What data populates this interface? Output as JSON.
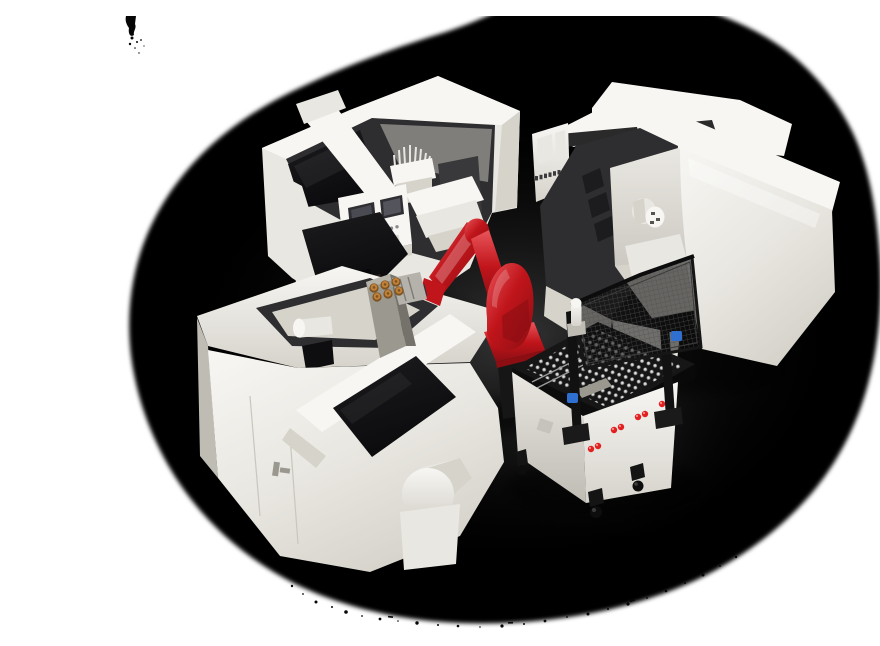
{
  "scene": {
    "title": "Robotic CNC machine tending cell",
    "alt": "3D render: three white CNC lathes around a red six-axis industrial robot holding brass parts, with a parts staging cart, pin pallet, safety mesh fence and signal column on a black floor"
  },
  "palette": {
    "background": "#ffffff",
    "blob_black": "#050505",
    "floor_center": "#3a3a3c",
    "machine_hi": "#f7f6f3",
    "machine_mid": "#e9e7e1",
    "machine_shade": "#d6d3cb",
    "machine_deep": "#bfbcb4",
    "interior_dark": "#2e2d2f",
    "interior_gray": "#807e7b",
    "window_black": "#121214",
    "robot_red": "#c0151b",
    "robot_red_hi": "#e9555a",
    "robot_red_dark": "#8c0e13",
    "brass": "#c08138",
    "brass_dark": "#7c5220",
    "clamp_blue": "#2f6fd0",
    "knob_red": "#e32020",
    "pin_silver": "#e2e2e2",
    "pin_ring": "#9a9a9a",
    "mesh_line": "#4f4f4f",
    "metal_gray": "#9b988f",
    "pedestal_black": "#161616"
  },
  "objects": {
    "machine_rear_left": "cnc-lathe-rear-left",
    "machine_right": "cnc-lathe-right",
    "machine_front_left": "cnc-lathe-front-left",
    "robot": "six-axis-robot",
    "cart": "parts-staging-cart",
    "fence": "safety-mesh-fence",
    "signal_column": "signal-column"
  }
}
